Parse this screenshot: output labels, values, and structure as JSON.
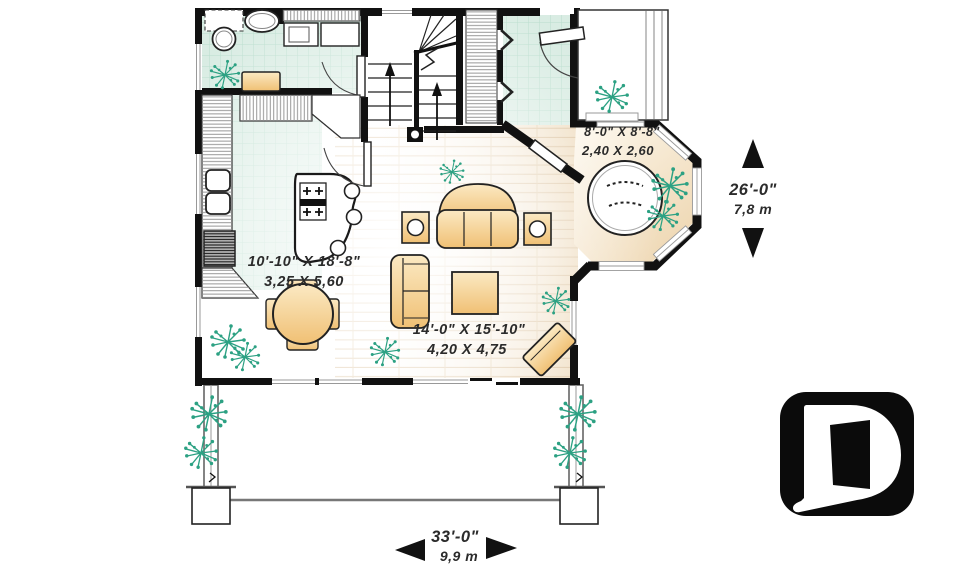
{
  "title": "house-first-floor-plan",
  "labels": {
    "nook": {
      "imperial": "8'-0\" X 8'-8\"",
      "metric": "2,40 X 2,60"
    },
    "dining": {
      "imperial": "10'-10\" X 18'-8\"",
      "metric": "3,25 X 5,60"
    },
    "living": {
      "imperial": "14'-0\" X 15'-10\"",
      "metric": "4,20 X 4,75"
    }
  },
  "dimensions": {
    "depth": {
      "imperial": "26'-0\"",
      "metric": "7,8 m"
    },
    "width": {
      "imperial": "33'-0\"",
      "metric": "9,9 m"
    }
  },
  "colors": {
    "wall": "#111111",
    "tile_floor": "#d9ece3",
    "tile_grid": "#b9ddcd",
    "wood_line": "#dcc3a0",
    "furniture_tan_light": "#fbe9c3",
    "furniture_tan_dark": "#f0c074",
    "plant_green": "#2ca183",
    "window_frame_gray": "#999999",
    "logo_black": "#0b0b0b"
  },
  "logo": {
    "name": "drummond-d-logo"
  }
}
